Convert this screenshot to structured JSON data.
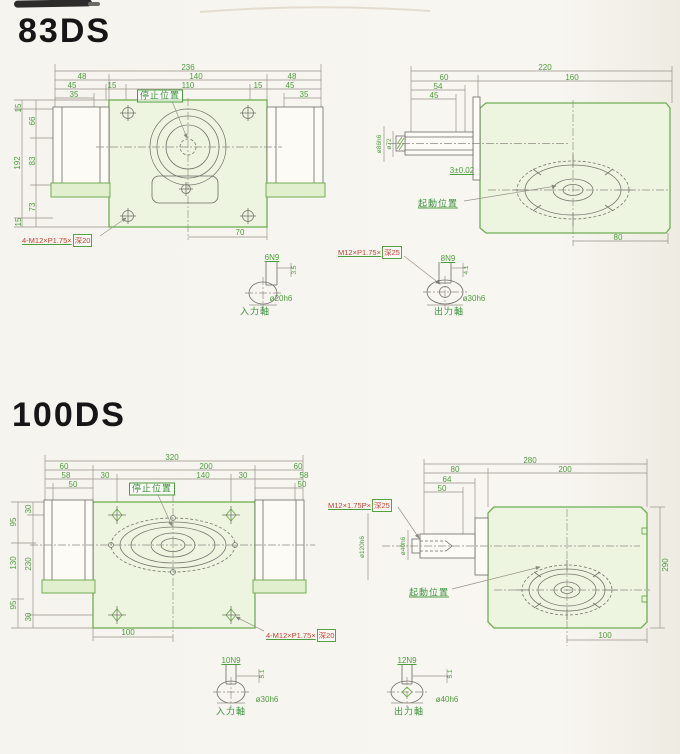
{
  "ds83": {
    "title": "83DS",
    "front": {
      "stop_position": "停止位置",
      "bolt_thread": "4-M12×P1.75×",
      "bolt_thread_depth": "深20",
      "dim_236": "236",
      "dim_140": "140",
      "dim_110": "110",
      "dim_48_left": "48",
      "dim_45_left": "45",
      "dim_35_left": "35",
      "dim_15_left": "15",
      "dim_48_right": "48",
      "dim_45_right": "45",
      "dim_35_right": "35",
      "dim_15_right": "15",
      "dim_15_top": "15",
      "dim_66": "66",
      "dim_192": "192",
      "dim_83": "83",
      "dim_73": "73",
      "dim_15_bottom": "15",
      "dim_70": "70"
    },
    "side": {
      "dim_220": "220",
      "dim_60": "60",
      "dim_160": "160",
      "dim_54": "54",
      "dim_45": "45",
      "tolerance": "3±0.02",
      "start_position": "起動位置",
      "dim_80": "80",
      "dia_boss": "ø86h6",
      "dia_shaft": "ø72"
    },
    "input_shaft": {
      "label": "入力軸",
      "keyway": "6N9",
      "key_depth": "3.5",
      "diameter": "ø20h6"
    },
    "output_shaft": {
      "label": "出力軸",
      "keyway": "8N9",
      "key_depth": "4.1",
      "diameter": "ø30h6",
      "tap_thread": "M12×P1.75×",
      "tap_depth": "深25"
    }
  },
  "ds100": {
    "title": "100DS",
    "front": {
      "stop_position": "停止位置",
      "bolt_thread": "4-M12×P1.75×",
      "bolt_thread_depth": "深20",
      "dim_320": "320",
      "dim_200": "200",
      "dim_140": "140",
      "dim_60_left": "60",
      "dim_58_left": "58",
      "dim_50_left": "50",
      "dim_30_left": "30",
      "dim_60_right": "60",
      "dim_58_right": "58",
      "dim_50_right": "50",
      "dim_30_right": "30",
      "dim_95_top": "95",
      "dim_130": "130",
      "dim_95_bottom": "95",
      "dim_30_top": "30",
      "dim_230": "230",
      "dim_30_bottom": "30",
      "dim_100": "100"
    },
    "side": {
      "dim_280": "280",
      "dim_80": "80",
      "dim_200": "200",
      "dim_64": "64",
      "dim_50": "50",
      "dim_290": "290",
      "dim_100": "100",
      "start_position": "起動位置",
      "tap_thread": "M12×1.75P×",
      "tap_depth": "深25",
      "dia_boss": "ø120h6",
      "dia_shaft": "ø40h6"
    },
    "input_shaft": {
      "label": "入力軸",
      "keyway": "10N9",
      "key_depth": "5.1",
      "diameter": "ø30h6"
    },
    "output_shaft": {
      "label": "出力軸",
      "keyway": "12N9",
      "key_depth": "5.1",
      "diameter": "ø40h6"
    }
  }
}
